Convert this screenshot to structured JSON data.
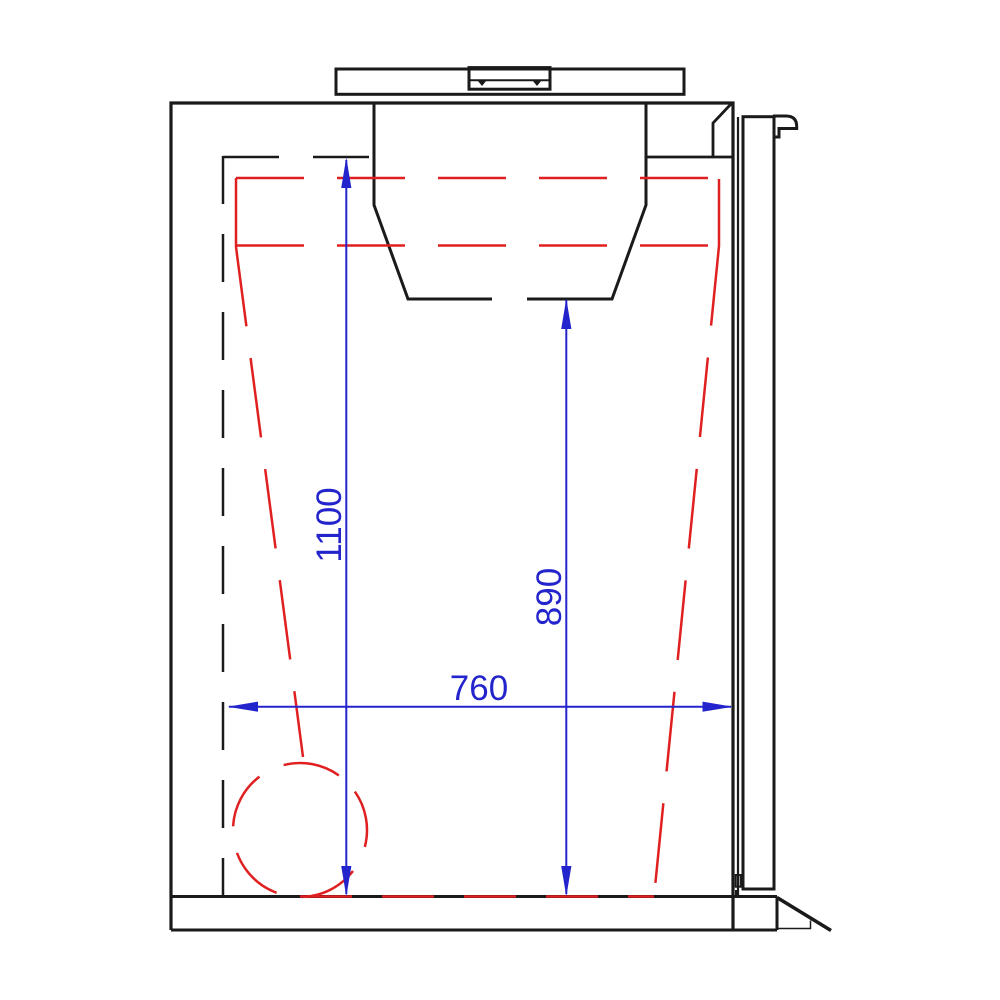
{
  "drawing": {
    "kind": "technical-side-section-drawing",
    "colors": {
      "outline": "#1a1a1a",
      "dimension": "#2424cc",
      "hidden_detail": "#e02020",
      "background": "#ffffff"
    },
    "dimensions": [
      {
        "id": "overall-inner-height",
        "value": "1100",
        "orientation": "vertical"
      },
      {
        "id": "hopper-clearance-height",
        "value": "890",
        "orientation": "vertical"
      },
      {
        "id": "inner-width",
        "value": "760",
        "orientation": "horizontal"
      }
    ]
  }
}
